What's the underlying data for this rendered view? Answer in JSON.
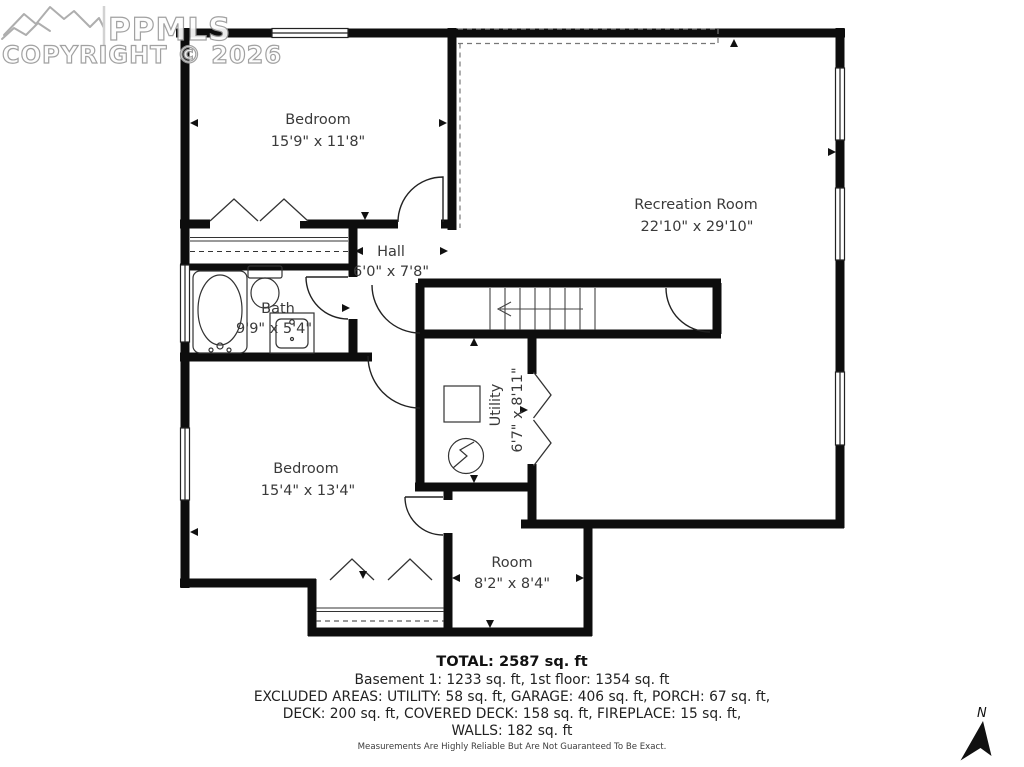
{
  "watermark": {
    "brand": "PPMLS",
    "copyright": "COPYRIGHT © 2026",
    "logo_icon": "mountain-range-icon"
  },
  "rooms": [
    {
      "name": "Bedroom",
      "dimensions": "15'9\" x 11'8\""
    },
    {
      "name": "Recreation Room",
      "dimensions": "22'10\" x 29'10\""
    },
    {
      "name": "Hall",
      "dimensions": "6'0\" x 7'8\""
    },
    {
      "name": "Bath",
      "dimensions": "9'9\" x 5'4\""
    },
    {
      "name": "Utility",
      "dimensions": "6'7\" x 8'11\""
    },
    {
      "name": "Bedroom",
      "dimensions": "15'4\" x 13'4\""
    },
    {
      "name": "Room",
      "dimensions": "8'2\" x 8'4\""
    }
  ],
  "summary": {
    "total": "TOTAL: 2587 sq. ft",
    "line1": "Basement 1: 1233 sq. ft, 1st floor: 1354 sq. ft",
    "line2": "EXCLUDED AREAS: UTILITY: 58 sq. ft, GARAGE: 406 sq. ft, PORCH: 67 sq. ft,",
    "line3": "DECK: 200 sq. ft, COVERED DECK: 158 sq. ft, FIREPLACE: 15 sq. ft,",
    "line4": "WALLS: 182 sq. ft",
    "disclaimer": "Measurements Are Highly Reliable But Are Not Guaranteed To Be Exact."
  },
  "compass": {
    "label": "N",
    "icon": "north-arrow-icon"
  },
  "colors": {
    "wall": "#0d0d0d",
    "text": "#3a3a3a",
    "watermark_outline": "#9a9a9a"
  }
}
